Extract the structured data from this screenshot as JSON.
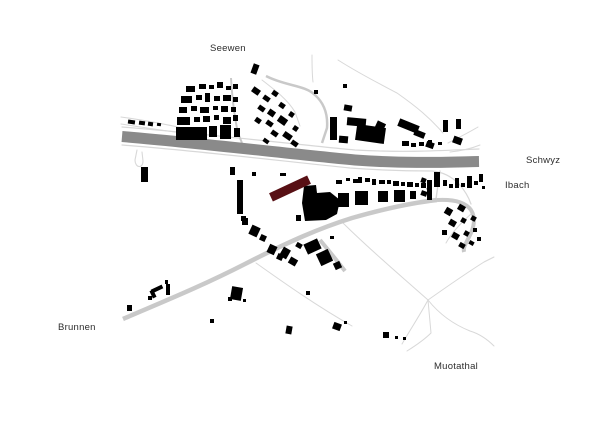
{
  "labels": {
    "seewen": "Seewen",
    "schwyz": "Schwyz",
    "ibach": "Ibach",
    "brunnen": "Brunnen",
    "muotathal": "Muotathal"
  },
  "colors": {
    "background": "#ffffff",
    "building": "#000000",
    "highlight": "#581015",
    "highway": "#8a8a8a",
    "road": "#c9c9c9",
    "path": "#d8d8d8",
    "label_text": "#2d2d2d"
  },
  "map": {
    "highway": {
      "d": "M122,136.5 C200,143 290,154 355,160 C410,164 450,162 479,161.5",
      "w": 11
    },
    "roads": [
      {
        "d": "M123,319 C160,303 200,287 245,264 C290,241 320,228 352,218 C380,210 410,203 437,200",
        "w": 4.5
      },
      {
        "d": "M437,200 C455,199 466,203 471,210 C476,218 474,228 469,237 C465,245 463,248 464,252",
        "w": 4
      },
      {
        "d": "M320,240 C330,252 338,262 345,271",
        "w": 4
      },
      {
        "d": "M266,76 C285,86 305,85 315,95 C325,104 328,115 327,128 L322,143",
        "w": 2.5
      },
      {
        "d": "M231,78 C232,95 234,115 238,133 L242,143",
        "w": 2
      }
    ],
    "thin_paths": [
      {
        "d": "M121,117 C150,121 175,126 205,133",
        "w": 1.1
      },
      {
        "d": "M121,124 C140,127 160,130 182,133",
        "w": 1
      },
      {
        "d": "M122,127 C200,133 290,144 355,150 C410,153 450,150 479,149",
        "w": 1.2
      },
      {
        "d": "M122,145 C200,151 290,162 350,168 C390,171 415,171 432,171 C444,172 452,177 459,184 C466,192 469,198 471,204",
        "w": 1.2
      },
      {
        "d": "M137,150 L135,160 C135,168 143,169 143,161 L142,152",
        "w": 1.1
      },
      {
        "d": "M440,171 L436,199",
        "w": 1.4
      },
      {
        "d": "M262,80 C275,90 288,100 295,112 L300,126",
        "w": 1
      },
      {
        "d": "M312,55 C312,65 312,74 313,82",
        "w": 1
      },
      {
        "d": "M338,60 C360,74 380,84 397,93 C417,107 430,118 443,133",
        "w": 1
      },
      {
        "d": "M478,127 C468,133 458,138 448,143",
        "w": 1
      },
      {
        "d": "M480,145 C470,149 460,151 450,152",
        "w": 1
      },
      {
        "d": "M342,222 C370,250 400,275 428,300",
        "w": 1
      },
      {
        "d": "M428,300 C420,315 410,330 402,344",
        "w": 1
      },
      {
        "d": "M428,300 L431,333 C424,340 415,346 407,351",
        "w": 1
      },
      {
        "d": "M428,300 C440,315 455,325 470,331 C480,334 488,340 494,346",
        "w": 1
      },
      {
        "d": "M428,300 C445,288 465,274 484,262 L494,257",
        "w": 1
      },
      {
        "d": "M256,263 C280,280 315,305 352,326",
        "w": 1
      },
      {
        "d": "M471,214 C462,222 452,232 446,243",
        "w": 1
      }
    ],
    "buildings": [
      [
        186,
        86,
        9,
        6,
        0
      ],
      [
        199,
        84,
        7,
        5,
        0
      ],
      [
        209,
        85,
        5,
        4,
        0
      ],
      [
        217,
        82,
        6,
        6,
        0
      ],
      [
        226,
        86,
        5,
        4,
        0
      ],
      [
        233,
        84,
        5,
        5,
        0
      ],
      [
        181,
        96,
        11,
        7,
        0
      ],
      [
        196,
        95,
        6,
        5,
        0
      ],
      [
        205,
        93,
        5,
        9,
        0
      ],
      [
        214,
        96,
        6,
        5,
        0
      ],
      [
        223,
        95,
        8,
        6,
        0
      ],
      [
        233,
        97,
        5,
        5,
        0
      ],
      [
        179,
        107,
        8,
        6,
        0
      ],
      [
        191,
        106,
        6,
        5,
        0
      ],
      [
        200,
        107,
        9,
        6,
        0
      ],
      [
        213,
        106,
        5,
        4,
        0
      ],
      [
        221,
        106,
        7,
        6,
        0
      ],
      [
        231,
        107,
        5,
        5,
        0
      ],
      [
        177,
        117,
        13,
        8,
        0
      ],
      [
        194,
        117,
        6,
        5,
        0
      ],
      [
        203,
        116,
        7,
        6,
        0
      ],
      [
        214,
        115,
        5,
        5,
        0
      ],
      [
        223,
        117,
        8,
        7,
        0
      ],
      [
        233,
        115,
        5,
        6,
        0
      ],
      [
        176,
        127,
        31,
        13,
        0
      ],
      [
        209,
        126,
        8,
        11,
        0
      ],
      [
        220,
        125,
        11,
        14,
        0
      ],
      [
        234,
        128,
        6,
        9,
        0
      ],
      [
        252,
        64,
        6,
        10,
        20
      ],
      [
        252,
        88,
        8,
        6,
        35
      ],
      [
        263,
        96,
        7,
        5,
        35
      ],
      [
        272,
        91,
        6,
        5,
        35
      ],
      [
        258,
        106,
        7,
        5,
        35
      ],
      [
        268,
        110,
        7,
        6,
        35
      ],
      [
        279,
        103,
        6,
        5,
        35
      ],
      [
        255,
        118,
        6,
        5,
        35
      ],
      [
        266,
        121,
        7,
        5,
        35
      ],
      [
        278,
        117,
        9,
        7,
        35
      ],
      [
        289,
        112,
        5,
        5,
        35
      ],
      [
        271,
        131,
        7,
        5,
        35
      ],
      [
        283,
        133,
        9,
        6,
        35
      ],
      [
        293,
        126,
        5,
        5,
        35
      ],
      [
        263,
        139,
        6,
        4,
        35
      ],
      [
        291,
        141,
        7,
        5,
        35
      ],
      [
        128,
        120,
        7,
        4,
        8
      ],
      [
        139,
        121,
        6,
        4,
        8
      ],
      [
        148,
        122,
        5,
        4,
        8
      ],
      [
        157,
        123,
        4,
        3,
        8
      ],
      [
        314,
        90,
        4,
        4,
        0
      ],
      [
        343,
        84,
        4,
        4,
        0
      ],
      [
        344,
        105,
        8,
        6,
        10
      ],
      [
        330,
        117,
        7,
        23,
        0
      ],
      [
        347,
        118,
        19,
        8,
        5
      ],
      [
        356,
        126,
        29,
        16,
        8
      ],
      [
        339,
        136,
        9,
        7,
        5
      ],
      [
        376,
        122,
        9,
        7,
        25
      ],
      [
        398,
        122,
        21,
        8,
        22
      ],
      [
        414,
        131,
        11,
        6,
        22
      ],
      [
        426,
        142,
        8,
        6,
        20
      ],
      [
        438,
        142,
        4,
        3,
        0
      ],
      [
        453,
        137,
        9,
        7,
        20
      ],
      [
        443,
        120,
        5,
        12,
        0
      ],
      [
        456,
        119,
        5,
        10,
        0
      ],
      [
        402,
        141,
        7,
        5,
        0
      ],
      [
        411,
        143,
        5,
        4,
        0
      ],
      [
        419,
        142,
        5,
        4,
        0
      ],
      [
        428,
        140,
        4,
        4,
        0
      ],
      [
        141,
        167,
        7,
        15,
        0
      ],
      [
        230,
        167,
        5,
        8,
        0
      ],
      [
        252,
        172,
        4,
        4,
        0
      ],
      [
        237,
        180,
        6,
        34,
        0
      ],
      [
        280,
        173,
        6,
        3,
        0
      ],
      [
        296,
        215,
        5,
        6,
        0
      ],
      [
        241,
        216,
        5,
        5,
        0
      ],
      [
        338,
        193,
        11,
        14,
        0
      ],
      [
        355,
        191,
        13,
        14,
        0
      ],
      [
        378,
        191,
        10,
        11,
        0
      ],
      [
        394,
        190,
        11,
        12,
        0
      ],
      [
        410,
        191,
        6,
        8,
        0
      ],
      [
        427,
        180,
        5,
        20,
        0
      ],
      [
        336,
        180,
        6,
        4,
        0
      ],
      [
        346,
        178,
        4,
        3,
        0
      ],
      [
        353,
        179,
        5,
        4,
        0
      ],
      [
        358,
        177,
        4,
        6,
        0
      ],
      [
        365,
        178,
        5,
        4,
        0
      ],
      [
        372,
        179,
        4,
        6,
        0
      ],
      [
        379,
        180,
        6,
        4,
        0
      ],
      [
        387,
        180,
        4,
        4,
        0
      ],
      [
        393,
        181,
        6,
        5,
        0
      ],
      [
        401,
        182,
        4,
        4,
        0
      ],
      [
        407,
        182,
        6,
        5,
        0
      ],
      [
        415,
        183,
        4,
        4,
        0
      ],
      [
        421,
        183,
        5,
        5,
        0
      ],
      [
        421,
        178,
        5,
        5,
        20
      ],
      [
        427,
        186,
        4,
        4,
        20
      ],
      [
        421,
        191,
        6,
        5,
        20
      ],
      [
        434,
        172,
        6,
        15,
        0
      ],
      [
        443,
        180,
        4,
        6,
        0
      ],
      [
        449,
        184,
        4,
        4,
        0
      ],
      [
        455,
        178,
        4,
        10,
        0
      ],
      [
        461,
        183,
        4,
        4,
        0
      ],
      [
        467,
        176,
        5,
        12,
        0
      ],
      [
        474,
        181,
        4,
        4,
        0
      ],
      [
        479,
        174,
        4,
        8,
        0
      ],
      [
        482,
        186,
        3,
        3,
        0
      ],
      [
        445,
        208,
        7,
        7,
        30
      ],
      [
        458,
        205,
        7,
        6,
        30
      ],
      [
        449,
        220,
        7,
        6,
        30
      ],
      [
        461,
        218,
        5,
        5,
        30
      ],
      [
        471,
        216,
        5,
        5,
        30
      ],
      [
        442,
        230,
        5,
        5,
        0
      ],
      [
        452,
        233,
        7,
        6,
        30
      ],
      [
        464,
        231,
        5,
        5,
        30
      ],
      [
        473,
        228,
        4,
        4,
        0
      ],
      [
        459,
        243,
        6,
        5,
        30
      ],
      [
        469,
        241,
        5,
        4,
        30
      ],
      [
        477,
        237,
        4,
        4,
        0
      ],
      [
        242,
        218,
        6,
        7,
        0
      ],
      [
        250,
        226,
        9,
        10,
        25
      ],
      [
        260,
        235,
        6,
        6,
        25
      ],
      [
        268,
        245,
        8,
        9,
        25
      ],
      [
        277,
        254,
        6,
        6,
        25
      ],
      [
        281,
        248,
        8,
        10,
        30
      ],
      [
        289,
        258,
        8,
        7,
        30
      ],
      [
        296,
        243,
        6,
        5,
        30
      ],
      [
        305,
        241,
        15,
        11,
        -25
      ],
      [
        318,
        251,
        13,
        13,
        -25
      ],
      [
        334,
        262,
        7,
        7,
        -25
      ],
      [
        330,
        236,
        4,
        3,
        0
      ],
      [
        286,
        326,
        6,
        8,
        10
      ],
      [
        306,
        291,
        4,
        4,
        0
      ],
      [
        333,
        323,
        8,
        7,
        20
      ],
      [
        344,
        321,
        3,
        3,
        0
      ],
      [
        383,
        332,
        6,
        6,
        0
      ],
      [
        395,
        336,
        3,
        3,
        0
      ],
      [
        403,
        337,
        3,
        3,
        0
      ],
      [
        127,
        305,
        5,
        6,
        0
      ],
      [
        148,
        296,
        4,
        4,
        0
      ],
      [
        151,
        287,
        12,
        4,
        -25
      ],
      [
        151,
        290,
        4,
        8,
        -25
      ],
      [
        165,
        280,
        3,
        4,
        0
      ],
      [
        166,
        284,
        4,
        11,
        0
      ],
      [
        231,
        287,
        11,
        13,
        10
      ],
      [
        228,
        297,
        4,
        4,
        0
      ],
      [
        243,
        299,
        3,
        3,
        0
      ],
      [
        210,
        319,
        4,
        4,
        0
      ]
    ],
    "complex_polygon": "304,186 316,185 317,193 330,192 340,200 337,214 326,220 305,221 302,203",
    "highlight_building": {
      "cx": 290,
      "cy": 188.5,
      "w": 42,
      "h": 9,
      "rot": -25
    }
  }
}
